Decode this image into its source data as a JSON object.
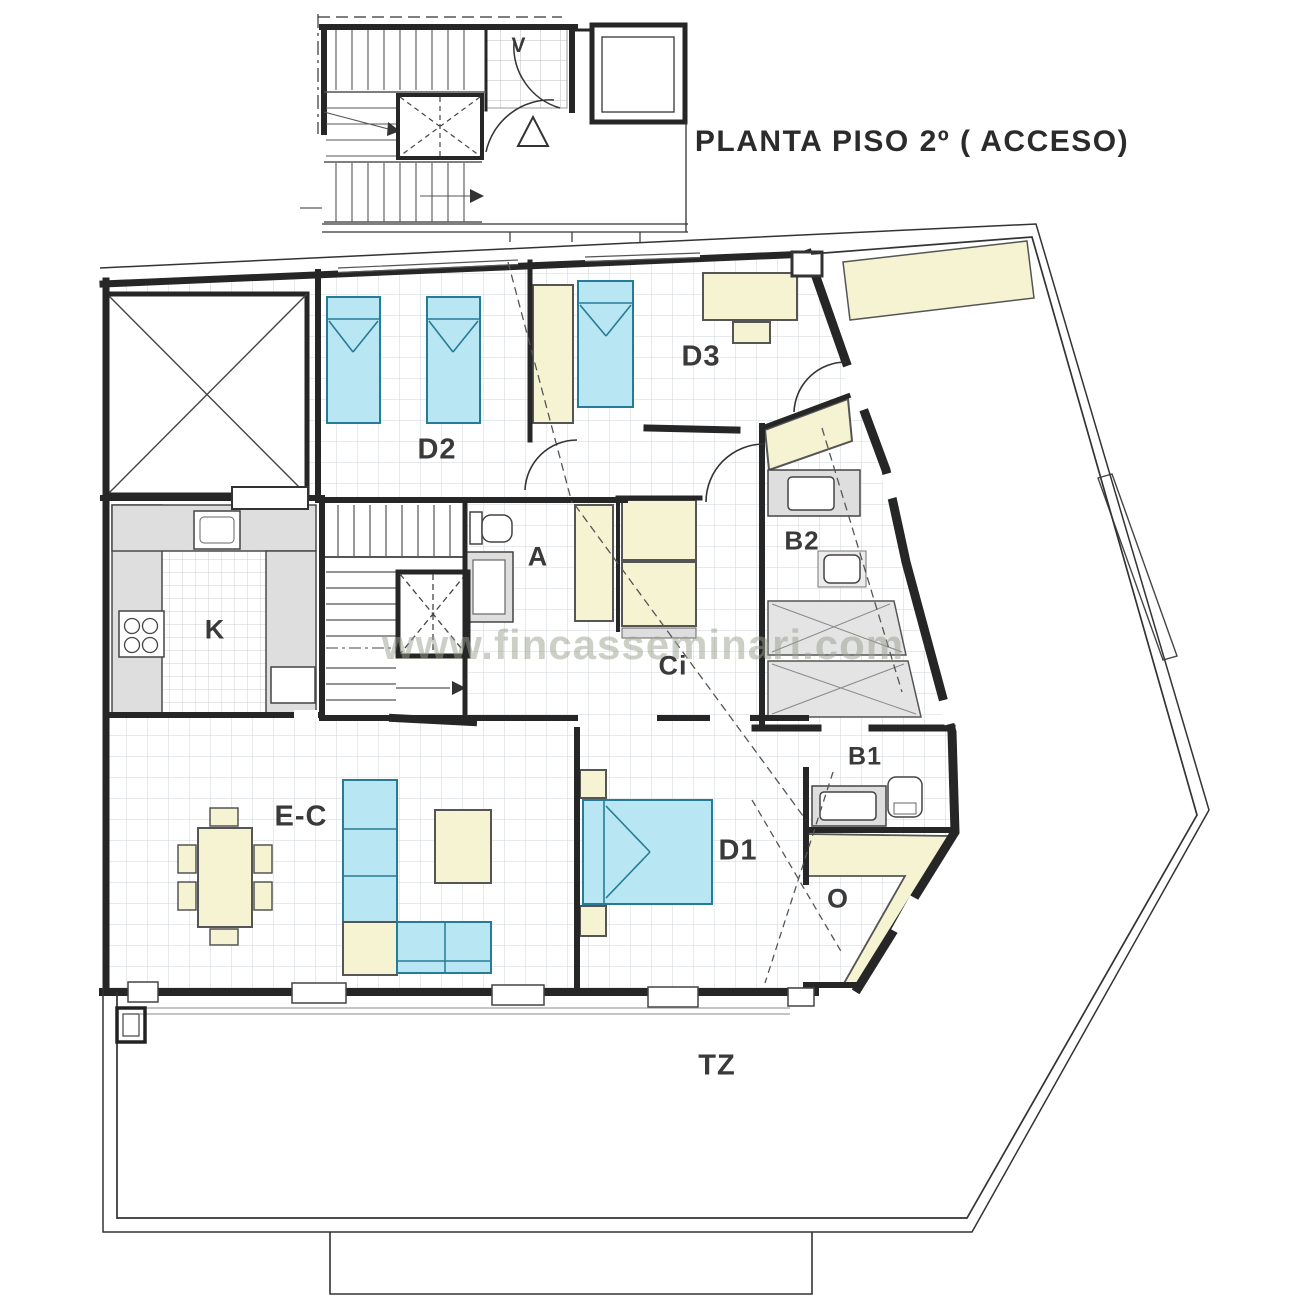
{
  "header": {
    "title": "PLANTA PISO 2º  ( ACCESO)"
  },
  "watermark": {
    "text": "www.fincasseminari.com"
  },
  "plan": {
    "rooms": {
      "v": "V",
      "d2": "D2",
      "d3": "D3",
      "a": "A",
      "ci": "Ci",
      "b2": "B2",
      "b1": "B1",
      "d1": "D1",
      "living": "E-C",
      "o": "O",
      "kitchen": "K",
      "terrace": "TZ"
    }
  },
  "colors": {
    "bed_fill": "#b9e6f3",
    "bed_stroke": "#267b97",
    "furniture_fill": "#f6f3d3",
    "furniture_stroke": "#6b6b52",
    "counter_fill": "#dedede",
    "counter_stroke": "#4a4a4a",
    "wall": "#262626",
    "line": "#3c3c3c",
    "grid": "#cfd5d8",
    "watermark": "#9aa08f"
  }
}
